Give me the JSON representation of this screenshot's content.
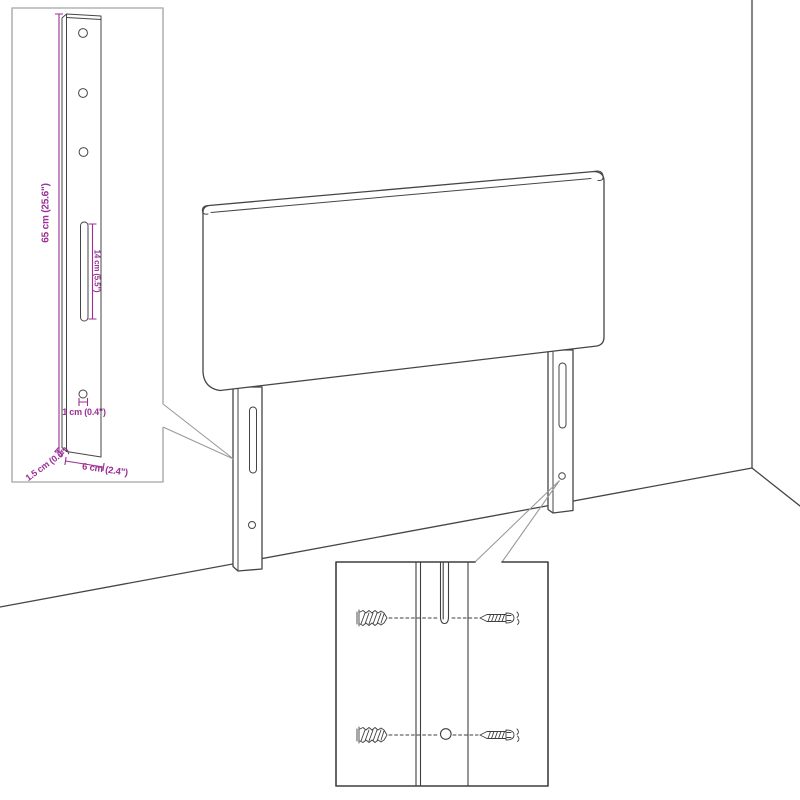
{
  "diagram": {
    "subject": "headboard-dimension-diagram",
    "colors": {
      "dimension_accent": "#9a2f94",
      "main_line": "#454545",
      "inset_border_light": "#b3b3b3",
      "inset_border_dark": "#3f3f3f",
      "background": "#ffffff"
    },
    "dimension_labels": {
      "leg_height": "65 cm (25.6\")",
      "slot_length": "14 cm (5.5\")",
      "hole_diameter": "1 cm (0.4\")",
      "leg_thickness": "1.5 cm (0.6\")",
      "leg_width": "6 cm (2.4\")"
    }
  }
}
